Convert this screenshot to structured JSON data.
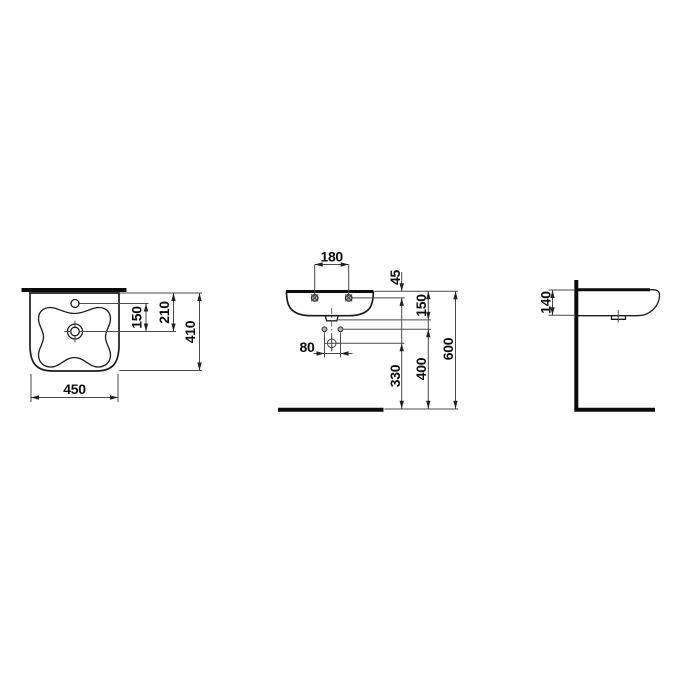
{
  "background": "#ffffff",
  "drawing": {
    "description": "Technical dimension drawing of a wall-hung washbasin, three orthographic views, dimensions in mm",
    "colors": {
      "thin_line": "#4a4a4a",
      "object_line": "#1c1c1c",
      "thick_line": "#0b0b0b",
      "text": "#0d0d0d",
      "hole_fill": "#b3b3b3"
    },
    "top_view": {
      "name": "plan view",
      "dim_faucet_to_drain": "150",
      "dim_wall_to_drain": "210",
      "dim_overall_depth": "410",
      "dim_overall_width": "450"
    },
    "front_view": {
      "name": "front view",
      "dim_fixing_holes_spacing": "180",
      "dim_rim_to_fixing_holes": "45",
      "dim_rim_to_outlet": "150",
      "dim_trap_holes_spacing": "80",
      "dim_floor_to_drain": "330",
      "dim_floor_to_bolts": "400",
      "dim_floor_to_rim": "600"
    },
    "side_view": {
      "name": "side view",
      "dim_front_apron_height": "140"
    }
  }
}
